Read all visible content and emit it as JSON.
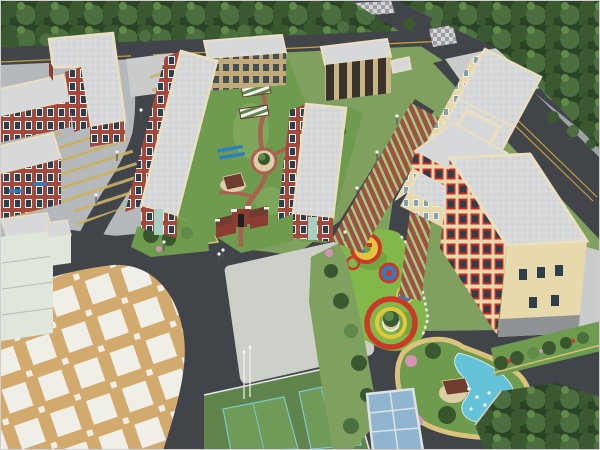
{
  "meta": {
    "kind": "aerial-architectural-rendering",
    "description": "Bird's-eye 3D rendering of a campus/residential master plan: red-brick apartment slabs around a landscaped courtyard, cream classroom buildings, perimeter roads with tree belt, checkered plaza, sports court, colorful playground, pond garden island and bicycle shed.",
    "width": 600,
    "height": 450
  },
  "scene": {
    "environment": [
      "forest-belt-top",
      "street-tree-row",
      "main-road-top",
      "main-road-right",
      "crosswalks",
      "side-road-east"
    ],
    "residential_west": [
      "l-shaped-brick-building",
      "brick-slab-2",
      "brick-slab-3",
      "parking-aprons-yellow-stripes",
      "internal-road",
      "street-lamps"
    ],
    "center": [
      "brick-slab-left",
      "brick-slab-right",
      "courtyard-garden",
      "pergolas",
      "garden-pavilion",
      "circular-plaza",
      "entrance-gate",
      "tan-dormitory",
      "colonnade-building"
    ],
    "east": [
      "classroom-building-long",
      "penthouse",
      "grass-paver-parking",
      "office-building-red-accents",
      "hedge-row"
    ],
    "south": [
      "checkered-plaza",
      "central-concrete-plaza",
      "flagpoles",
      "sports-court",
      "bicycle-shed",
      "playground-circles",
      "pond-garden-island",
      "median-planter",
      "tree-patch-southeast",
      "white-building-west"
    ]
  },
  "colors": {
    "base": "#7fa05e",
    "lawn": "#6f9b4e",
    "lawnLight": "#86ad62",
    "forestDark": "#2c4426",
    "forestMid": "#3b5931",
    "forestLight": "#4c6f3f",
    "treeLight": "#5f8a49",
    "treeDark": "#39572f",
    "treePink": "#d493b4",
    "road": "#414449",
    "roadLight": "#4b4e53",
    "lineYellow": "#c2a13d",
    "curb": "#cfd1cd",
    "sidewalk": "#9ba1a5",
    "concrete": "#b6b9bc",
    "concreteLight": "#c9cccb",
    "plaza": "#cdcfc9",
    "plaidTan": "#d3aa6e",
    "plaidWhite": "#efefe8",
    "checkLight": "#d3d5d7",
    "checkDark": "#9c9ea1",
    "roofGray": "#d6d8da",
    "roofDot": "#c6c8ca",
    "roofDot2": "#e4e6e8",
    "parapet": "#eadfc1",
    "brick": "#a3483a",
    "brickDark": "#8c3d31",
    "winDark": "#2f3e4b",
    "winFrame": "#eceff0",
    "glass": "#a9cfc2",
    "tanWall": "#c2ab7b",
    "colDark": "#3a332b",
    "colTan": "#c9b484",
    "cream": "#e7d9ab",
    "creamWin": "#84a0af",
    "redAccent": "#ce2b26",
    "paver": "#9e5142",
    "paverStripe": "#a3c87e",
    "pathRed": "#aa614f",
    "pathTan": "#d9c27c",
    "playGreen": "#82b84a",
    "playGreenDark": "#6ea13d",
    "playRed": "#cb3a28",
    "playYellow": "#e5c53d",
    "playBlue": "#2e7fc2",
    "pond": "#64c3d8",
    "deck": "#dccea7",
    "pavRoof": "#6f3c30",
    "shedBlue": "#8fb5d0",
    "shedFrame": "#dde2e5",
    "court": "#5f854d",
    "courtLight": "#6f9a58",
    "courtLine": "#7cc8ce",
    "fence": "#e7e9e7",
    "whiteWall": "#dfe7dd",
    "stone": "#8f9295",
    "lamp": "#53565a",
    "white": "#f2f3f2",
    "yellowStripe": "#c9b366"
  }
}
